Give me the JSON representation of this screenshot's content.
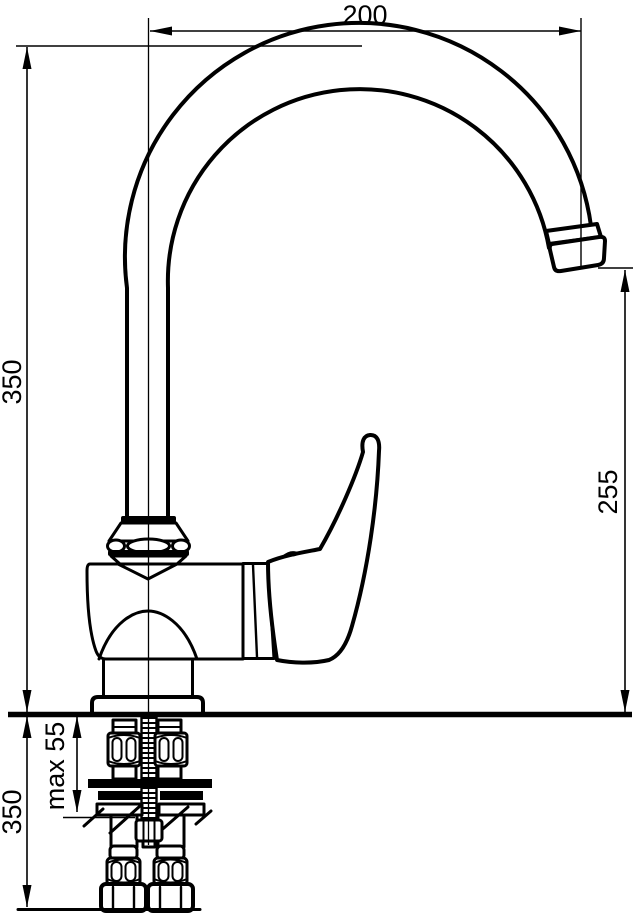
{
  "drawing": {
    "title": "Kitchen faucet installation dimensional drawing",
    "background": "#ffffff",
    "stroke_color": "#000000",
    "labels": {
      "spout_reach": "200",
      "height_above_deck": "350",
      "outlet_height": "255",
      "max_deck_thickness": "max 55",
      "below_deck_depth": "350"
    }
  }
}
